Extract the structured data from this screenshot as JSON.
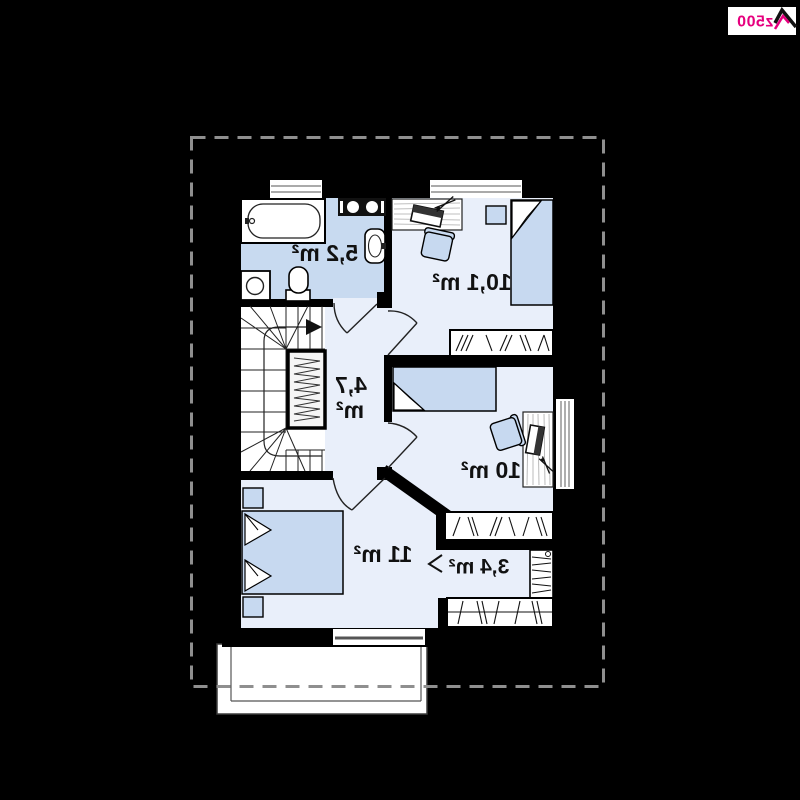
{
  "logo": {
    "brand": "z500",
    "accent_color": "#e6007e"
  },
  "floor_plan": {
    "orientation_note": "plan rendered mirrored (labels read right-to-left in pixels)",
    "colors": {
      "background": "#000000",
      "room_floor": "#e9effa",
      "bathroom_floor": "#c8daf0",
      "furniture_blue": "#c7d9f0",
      "dashed_outline": "#8f8f8f"
    },
    "rooms": [
      {
        "id": "bathroom",
        "area_label": "5,2 m²"
      },
      {
        "id": "bedroom-1",
        "area_label": "10,1 m²"
      },
      {
        "id": "hallway",
        "area_label_line1": "4,7",
        "area_label_line2": "m²"
      },
      {
        "id": "bedroom-2",
        "area_label": "10 m²"
      },
      {
        "id": "bedroom-3",
        "area_label": "11 m²"
      },
      {
        "id": "closet",
        "area_label": "3,4 m²"
      }
    ]
  }
}
